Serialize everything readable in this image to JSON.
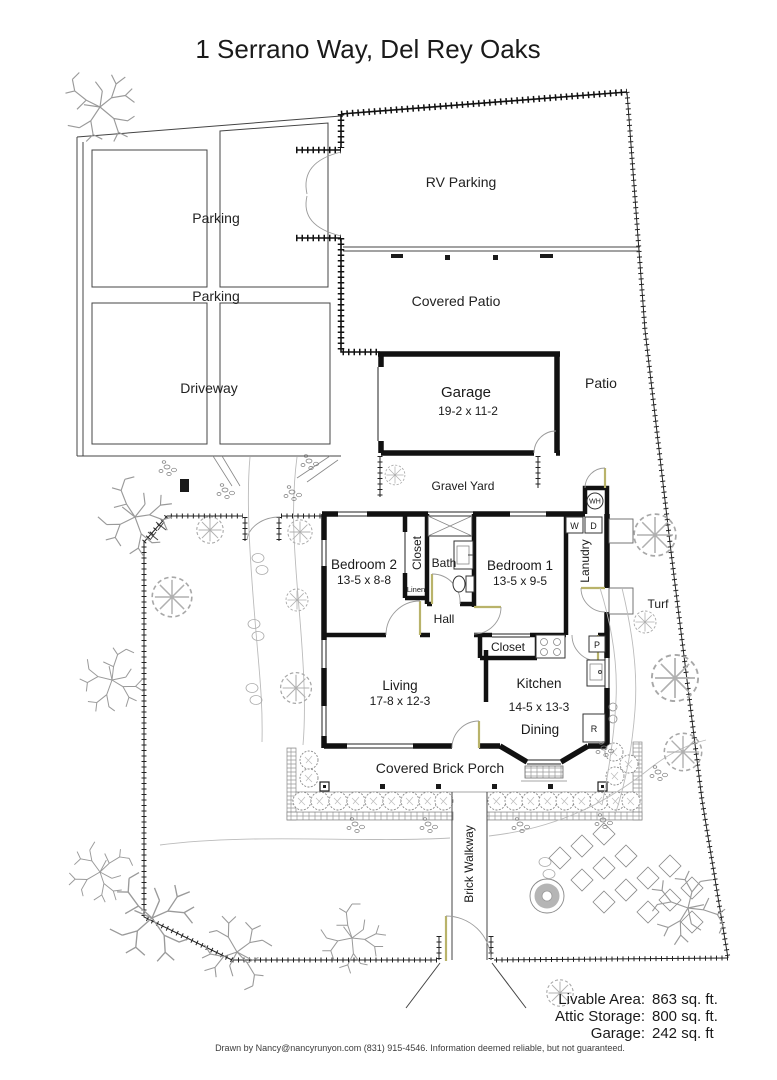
{
  "title": "1 Serrano Way, Del Rey Oaks",
  "site": {
    "rv_parking": "RV Parking",
    "covered_patio": "Covered Patio",
    "parking_upper": "Parking",
    "parking_lower": "Parking",
    "driveway": "Driveway",
    "patio": "Patio",
    "gravel_yard": "Gravel Yard",
    "turf": "Turf",
    "brick_walkway": "Brick Walkway",
    "covered_brick_porch": "Covered Brick Porch"
  },
  "rooms": {
    "garage": {
      "name": "Garage",
      "dims": "19-2 x 11-2"
    },
    "bedroom2": {
      "name": "Bedroom 2",
      "dims": "13-5 x 8-8"
    },
    "bedroom1": {
      "name": "Bedroom 1",
      "dims": "13-5 x 9-5"
    },
    "living": {
      "name": "Living",
      "dims": "17-8 x 12-3"
    },
    "kitchen": {
      "name": "Kitchen",
      "dims": "14-5 x 13-3"
    },
    "dining": "Dining",
    "bath": "Bath",
    "hall": "Hall",
    "laundry": "Lanudry",
    "bedroom2_closet": "Closet",
    "hall_closet": "Closet",
    "linen": "Linen"
  },
  "markers": {
    "water_heater": "WH",
    "washer": "W",
    "dryer": "D",
    "pantry": "P",
    "refrigerator": "R"
  },
  "summary": {
    "rows": [
      {
        "label": "Livable Area:",
        "value": "863 sq. ft."
      },
      {
        "label": "Attic Storage:",
        "value": "800 sq. ft."
      },
      {
        "label": "Garage:",
        "value": "242 sq. ft"
      }
    ]
  },
  "footer": {
    "text": "Drawn by Nancy@nancyrunyon.com (831) 915-4546.  Information deemed reliable, but not guaranteed."
  },
  "colors": {
    "line": "#1a1a1a",
    "tree": "#9a9a9a",
    "door_accent": "#b9b36a",
    "fountain_ring": "#b5b5b5"
  }
}
